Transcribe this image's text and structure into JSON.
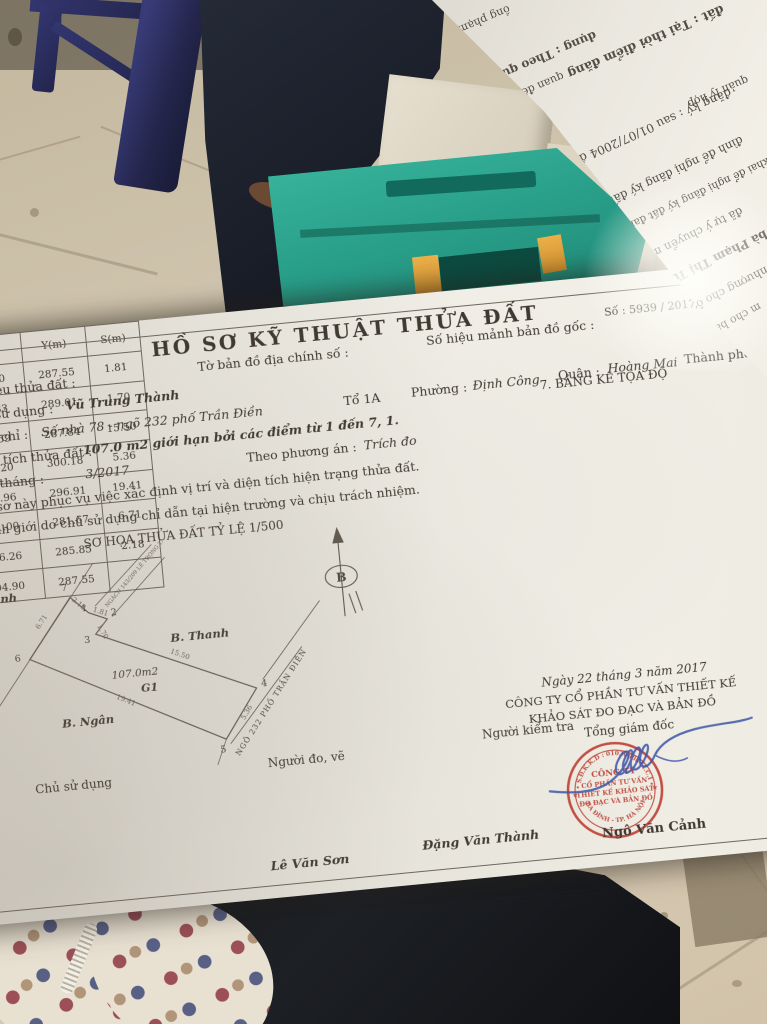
{
  "photo_context": {
    "objects": [
      "floor-tiles",
      "blue-plastic-stool",
      "jeans-leg",
      "cream-box",
      "teal-plastic-box",
      "black-fabric",
      "polka-dot-fabric"
    ],
    "colors": {
      "floor": "#d3c8b2",
      "stool": "#2b2e63",
      "teal_box": "#2aa18b",
      "tab_yellow": "#e0a43c",
      "stamp_red": "#bf3a2e",
      "signature_blue": "#3c55a8"
    }
  },
  "document": {
    "title": "HỒ SƠ KỸ THUẬT THỬA ĐẤT",
    "doc_number": "Số :  5939 / 2017/HSKT",
    "row1": {
      "f1": "1. Số hiệu thửa đất :",
      "f2": "Tờ bản đồ địa chính số :",
      "f3": "Số hiệu mảnh bản đồ gốc :"
    },
    "row2": {
      "label": "2. Chủ sử dụng :",
      "value": "Vũ Trung Thành"
    },
    "row3": {
      "addr_label": "Địa chỉ :",
      "addr_value": "Số nhà 78 - ngõ 232 phố Trần Điền",
      "to": "Tổ 1A",
      "phuong_label": "Phường :",
      "phuong": "Định Công",
      "quan_label": "Quận :",
      "quan": "Hoàng Mai",
      "tp_label": "Thành phố :",
      "tp": "Hà Nội"
    },
    "row4": {
      "label": "3. Diện tích thửa đất :",
      "value": "107.0 m2 giới hạn bởi các điểm từ 1 đến 7, 1."
    },
    "row5": {
      "label": "4. Lập tháng :",
      "value": "3/2017",
      "label2": "Theo phương án :",
      "value2": "Trích đo"
    },
    "row6": "5. Hồ sơ này phục vụ việc xác định vị trí và diện tích hiện trạng thửa đất.",
    "row7": "6. Ranh giới do chủ sử dụng chỉ dẫn tại hiện trường và chịu trách nhiệm.",
    "sketch_title": "SƠ HỌA THỬA ĐẤT TỶ LỆ 1/500",
    "sketch": {
      "north_symbol": "B",
      "neighbors": {
        "left": "Ô. Minh",
        "right": "B. Thanh",
        "bottom": "B. Ngân"
      },
      "area": "107.0m2",
      "group": "G1",
      "road": "NGÕ 232 PHỐ TRẦN ĐIỀN",
      "alley": "NGÁCH 143/209 LÊ TRỌNG TẤN",
      "vertices": [
        "7",
        "1",
        "2",
        "3",
        "4",
        "5",
        "6"
      ],
      "dims": [
        "2.18",
        "1.81",
        "1.70",
        "15.50",
        "5.36",
        "19.41",
        "6.71"
      ]
    },
    "coordinate_table": {
      "title": "7. BẢNG KÊ TỌA ĐỘ",
      "col_corner": "Số hiệu góc thửa",
      "col_x": "X(m)",
      "col_y": "Y(m)",
      "col_s": "S(m)",
      "rows": [
        {
          "n": "1",
          "x": "504.90",
          "y": "287.55",
          "s": "1.81"
        },
        {
          "n": "2",
          "x": "503.83",
          "y": "289.01",
          "s": "1.70"
        },
        {
          "n": "3",
          "x": "502.59",
          "y": "287.84",
          "s": "15.50"
        },
        {
          "n": "4",
          "x": "493.20",
          "y": "300.18",
          "s": "5.36"
        },
        {
          "n": "5",
          "x": "488.96",
          "y": "296.91",
          "s": "19.41"
        },
        {
          "n": "6",
          "x": "501.00",
          "y": "281.67",
          "s": "6.71"
        },
        {
          "n": "7",
          "x": "506.26",
          "y": "285.85",
          "s": "2.18"
        },
        {
          "n": "1",
          "x": "504.90",
          "y": "287.55",
          "s": ""
        }
      ]
    },
    "date_line": "Ngày  22  tháng  3   năm 2017",
    "company_line1": "CÔNG TY CỔ PHẦN TƯ VẤN THIẾT KẾ",
    "company_line2": "KHẢO SÁT ĐO ĐẠC VÀ BẢN ĐỒ",
    "signer_title": "Tổng giám đốc",
    "stamp": {
      "arc_top": "• S.Đ.K.K.D : 0103000644.C.I •",
      "arc_bottom": "BA ĐÌNH - TP. HÀ NỘI",
      "line1": "CÔNG TY",
      "line2": "CỔ PHẦN TƯ VẤN",
      "line3": "THIẾT KẾ KHẢO SÁT",
      "line4": "ĐO ĐẠC VÀ BẢN ĐỒ"
    },
    "sig_labels": {
      "owner": "Chủ sử dụng",
      "surveyor": "Người đo, vẽ",
      "checker": "Người kiểm tra"
    },
    "sig_names": {
      "surveyor": "Lê Văn Sơn",
      "checker": "Đặng Văn Thành",
      "director": "Ngô Văn Cảnh"
    }
  },
  "overlay_paper": {
    "fragments": [
      "ồng phạm vi",
      "dụng : Theo quy",
      "đất : Tại thời điểm đăng",
      "quan đến đất đai",
      "quản lý hợp",
      "đăng ký : sau 01/07/2004 đến trước",
      "đình để nghị đăng ký đất đai cùng",
      "đã khai để nghị đăng ký đất đai và nhà khác sẽ thực",
      "đã tự ý chuyển mục đích",
      "bà Phạm Thị Tuyết Ngân",
      "nhượng cho ông Vũ T",
      "m cho bà Ngư"
    ]
  }
}
